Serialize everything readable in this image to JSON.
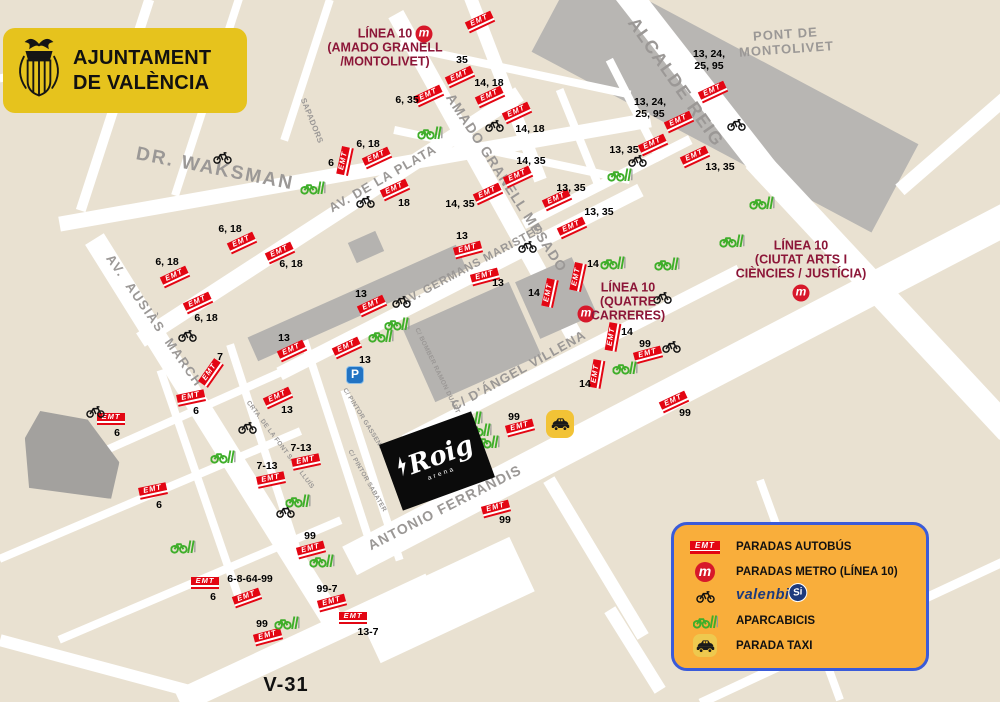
{
  "header": {
    "line1": "AJUNTAMENT",
    "line2": "DE VALÈNCIA"
  },
  "labels": {
    "emt": "EMT",
    "metro_letter": "m"
  },
  "venue": {
    "name": "Roig",
    "sub": "arena"
  },
  "parking": {
    "label": "P",
    "x": 355,
    "y": 375
  },
  "taxi_stands": [
    [
      560,
      424
    ]
  ],
  "colors": {
    "emt_red": "#e30613",
    "metro_red": "#d7182a",
    "metro_label_maroon": "#8c1638",
    "green": "#3fae2a",
    "legend_bg": "#f9ae3b",
    "legend_border": "#3a5bd9",
    "badge_yellow": "#e6c31d",
    "taxi_yellow": "#f2c336",
    "parking_blue": "#2273c3",
    "street_gray": "#9b9896",
    "land_beige": "#e9e1d1",
    "road_white": "#ffffff",
    "building_gray": "#b5b3b0",
    "dark_block_gray": "#a3a19e",
    "number_black": "#000000"
  },
  "legend": {
    "items": [
      {
        "icon": "emt",
        "label": "PARADAS AUTOBÚS"
      },
      {
        "icon": "metro",
        "label": "PARADAS METRO (LÍNEA 10)"
      },
      {
        "icon": "bike",
        "logo_main": "valenbi",
        "logo_badge": "Si",
        "label": "valenbisi"
      },
      {
        "icon": "aparcabicis",
        "label": "APARCABICIS"
      },
      {
        "icon": "taxi",
        "label": "PARADA TAXI"
      }
    ]
  },
  "metro_labels": [
    {
      "text": "LÍNEA 10\n(AMADO GRANELL\n/MONTOLIVET)",
      "x": 385,
      "y": 48
    },
    {
      "text": "LÍNEA 10\n(QUATRE\nCARRERES)",
      "x": 628,
      "y": 302
    },
    {
      "text": "LÍNEA 10\n(CIUTAT ARTS I\nCIÈNCIES / JUSTÍCIA)",
      "x": 801,
      "y": 260
    }
  ],
  "metro_stations": [
    [
      424,
      34
    ],
    [
      586,
      314
    ],
    [
      801,
      293
    ]
  ],
  "streets": [
    {
      "name": "DR. WAKSMAN",
      "x": 215,
      "y": 169,
      "rot": 11,
      "size": 19,
      "ls": 2
    },
    {
      "name": "AV.  AUSIÀS  MARCH",
      "x": 154,
      "y": 321,
      "rot": 55,
      "size": 13,
      "ls": 1.5
    },
    {
      "name": "AV. DE LA PLATA",
      "x": 383,
      "y": 179,
      "rot": -30,
      "size": 13,
      "ls": 1
    },
    {
      "name": "AMADO GRANELL MESADO",
      "x": 506,
      "y": 183,
      "rot": 57,
      "size": 14,
      "ls": 1
    },
    {
      "name": "ALCALDE REIG",
      "x": 676,
      "y": 82,
      "rot": 55,
      "size": 18,
      "ls": 1.5
    },
    {
      "name": "PONT DE\nMONTOLIVET",
      "x": 786,
      "y": 42,
      "rot": -4,
      "size": 13,
      "ls": 1
    },
    {
      "name": "AV. GERMANS MARISTES",
      "x": 473,
      "y": 266,
      "rot": -28,
      "size": 11.5,
      "ls": 0.8
    },
    {
      "name": "C/ D'ÁNGEL VILLENA",
      "x": 519,
      "y": 371,
      "rot": -29,
      "size": 13,
      "ls": 1
    },
    {
      "name": "ANTONIO FERRANDIS",
      "x": 445,
      "y": 508,
      "rot": -27,
      "size": 14,
      "ls": 1.2
    },
    {
      "name": "SAPADORS",
      "x": 311,
      "y": 121,
      "rot": 68,
      "size": 8,
      "ls": 0.4
    },
    {
      "name": "C/ BOMBER RAMON DUART",
      "x": 437,
      "y": 371,
      "rot": 64,
      "size": 6.5,
      "ls": 0.3
    },
    {
      "name": "CRTA. DE LA FONT SANT LLUÍS",
      "x": 280,
      "y": 445,
      "rot": 53,
      "size": 6.5,
      "ls": 0.3
    },
    {
      "name": "C/ PINTOR GASSENT",
      "x": 363,
      "y": 419,
      "rot": 58,
      "size": 6.5,
      "ls": 0.3
    },
    {
      "name": "C/ PINTOR SABATER",
      "x": 367,
      "y": 481,
      "rot": 60,
      "size": 6.5,
      "ls": 0.3
    },
    {
      "name": "V-31",
      "x": 286,
      "y": 685,
      "rot": 0,
      "size": 20,
      "ls": 1,
      "color": "#101010"
    }
  ],
  "bus_stops": [
    [
      480,
      22,
      -25
    ],
    [
      460,
      77,
      -25
    ],
    [
      429,
      96,
      -25
    ],
    [
      490,
      97,
      -25
    ],
    [
      517,
      113,
      -25
    ],
    [
      345,
      161,
      -78
    ],
    [
      377,
      158,
      -25
    ],
    [
      242,
      243,
      -25
    ],
    [
      175,
      277,
      -25
    ],
    [
      280,
      253,
      -25
    ],
    [
      198,
      303,
      -25
    ],
    [
      488,
      194,
      -25
    ],
    [
      518,
      177,
      -25
    ],
    [
      395,
      190,
      -25
    ],
    [
      557,
      200,
      -25
    ],
    [
      572,
      228,
      -25
    ],
    [
      653,
      145,
      -25
    ],
    [
      679,
      122,
      -25
    ],
    [
      713,
      92,
      -25
    ],
    [
      695,
      157,
      -25
    ],
    [
      578,
      277,
      -78
    ],
    [
      550,
      293,
      -78
    ],
    [
      485,
      277,
      -15
    ],
    [
      468,
      250,
      -15
    ],
    [
      372,
      306,
      -25
    ],
    [
      292,
      351,
      -25
    ],
    [
      347,
      348,
      -25
    ],
    [
      211,
      373,
      -55
    ],
    [
      191,
      398,
      -12
    ],
    [
      111,
      419,
      0
    ],
    [
      278,
      398,
      -25
    ],
    [
      306,
      462,
      -12
    ],
    [
      271,
      480,
      -12
    ],
    [
      153,
      491,
      -12
    ],
    [
      311,
      550,
      -15
    ],
    [
      205,
      583,
      0
    ],
    [
      247,
      598,
      -20
    ],
    [
      332,
      603,
      -15
    ],
    [
      268,
      637,
      -15
    ],
    [
      353,
      618,
      0
    ],
    [
      496,
      509,
      -15
    ],
    [
      520,
      428,
      -15
    ],
    [
      597,
      374,
      -80
    ],
    [
      613,
      337,
      -80
    ],
    [
      648,
      355,
      -15
    ],
    [
      674,
      402,
      -25
    ]
  ],
  "bus_numbers": [
    [
      "35",
      462,
      60
    ],
    [
      "6, 35",
      407,
      100
    ],
    [
      "14, 18",
      489,
      83
    ],
    [
      "14, 18",
      530,
      129
    ],
    [
      "6",
      331,
      163
    ],
    [
      "6, 18",
      368,
      144
    ],
    [
      "6, 18",
      230,
      229
    ],
    [
      "6, 18",
      167,
      262
    ],
    [
      "6, 18",
      291,
      264
    ],
    [
      "6, 18",
      206,
      318
    ],
    [
      "14, 35",
      460,
      204
    ],
    [
      "14, 35",
      531,
      161
    ],
    [
      "18",
      404,
      203
    ],
    [
      "13, 35",
      571,
      188
    ],
    [
      "13, 35",
      599,
      212
    ],
    [
      "13, 35",
      624,
      150
    ],
    [
      "13, 24,\n25, 95",
      650,
      108
    ],
    [
      "13, 24,\n25, 95",
      709,
      60
    ],
    [
      "13, 35",
      720,
      167
    ],
    [
      "14",
      593,
      264
    ],
    [
      "14",
      534,
      293
    ],
    [
      "13",
      498,
      283
    ],
    [
      "13",
      462,
      236
    ],
    [
      "13",
      361,
      294
    ],
    [
      "13",
      284,
      338
    ],
    [
      "13",
      365,
      360
    ],
    [
      "7",
      220,
      357
    ],
    [
      "6",
      196,
      411
    ],
    [
      "6",
      117,
      433
    ],
    [
      "13",
      287,
      410
    ],
    [
      "7-13",
      301,
      448
    ],
    [
      "7-13",
      267,
      466
    ],
    [
      "6",
      159,
      505
    ],
    [
      "99",
      310,
      536
    ],
    [
      "6-8-64-99",
      250,
      579
    ],
    [
      "6",
      213,
      597
    ],
    [
      "99-7",
      327,
      589
    ],
    [
      "99",
      262,
      624
    ],
    [
      "13-7",
      368,
      632
    ],
    [
      "99",
      505,
      520
    ],
    [
      "99",
      514,
      417
    ],
    [
      "14",
      585,
      384
    ],
    [
      "14",
      627,
      332
    ],
    [
      "99",
      645,
      344
    ],
    [
      "99",
      685,
      413
    ]
  ],
  "valenbisi_stations": [
    [
      223,
      158
    ],
    [
      96,
      412
    ],
    [
      366,
      202
    ],
    [
      495,
      126
    ],
    [
      638,
      161
    ],
    [
      737,
      125
    ],
    [
      402,
      302
    ],
    [
      528,
      247
    ],
    [
      663,
      298
    ],
    [
      672,
      347
    ],
    [
      248,
      428
    ],
    [
      286,
      512
    ],
    [
      188,
      336
    ]
  ],
  "bike_parkings": [
    [
      313,
      187
    ],
    [
      430,
      132
    ],
    [
      620,
      174
    ],
    [
      762,
      202
    ],
    [
      732,
      240
    ],
    [
      613,
      262
    ],
    [
      667,
      263
    ],
    [
      625,
      367
    ],
    [
      397,
      323
    ],
    [
      381,
      335
    ],
    [
      223,
      456
    ],
    [
      298,
      500
    ],
    [
      183,
      546
    ],
    [
      322,
      560
    ],
    [
      287,
      622
    ],
    [
      470,
      417
    ],
    [
      479,
      429
    ],
    [
      487,
      441
    ]
  ],
  "map": {
    "river": [
      725,
      98,
      385,
      100,
      28,
      "#b8b6b3"
    ],
    "gray_blocks": [
      [
        357,
        303,
        228,
        26,
        -24,
        "#b5b3b0",
        false
      ],
      [
        472,
        342,
        116,
        80,
        -24,
        "#b5b3b0",
        false
      ],
      [
        556,
        298,
        62,
        62,
        -24,
        "#b5b3b0",
        false
      ],
      [
        366,
        247,
        30,
        22,
        -24,
        "#b5b3b0",
        false
      ],
      [
        72,
        452,
        96,
        88,
        4,
        "#a3a19e",
        true
      ]
    ],
    "roads": [
      [
        355,
        172,
        600,
        15,
        -10
      ],
      [
        215,
        432,
        455,
        22,
        58
      ],
      [
        330,
        217,
        452,
        16,
        -33
      ],
      [
        485,
        175,
        368,
        17,
        61
      ],
      [
        695,
        80,
        230,
        26,
        52
      ],
      [
        882,
        295,
        372,
        26,
        47
      ],
      [
        460,
        282,
        405,
        14,
        -27
      ],
      [
        572,
        356,
        376,
        13,
        -27
      ],
      [
        680,
        389,
        745,
        32,
        -27.5
      ],
      [
        305,
        643,
        277,
        24,
        -25
      ],
      [
        100,
        667,
        207,
        12,
        15
      ],
      [
        504,
        85,
        204,
        13,
        69
      ],
      [
        445,
        600,
        170,
        60,
        -25
      ],
      [
        115,
        105,
        222,
        10,
        -72
      ],
      [
        207,
        97,
        207,
        8,
        -72
      ],
      [
        307,
        70,
        148,
        8,
        -72
      ],
      [
        110,
        57,
        225,
        8,
        -11
      ],
      [
        185,
        415,
        318,
        8,
        -24
      ],
      [
        150,
        495,
        327,
        8,
        -23
      ],
      [
        200,
        580,
        306,
        8,
        -23
      ],
      [
        265,
        452,
        226,
        8,
        72
      ],
      [
        200,
        485,
        243,
        8,
        71
      ],
      [
        335,
        435,
        221,
        8,
        72
      ],
      [
        372,
        475,
        179,
        8,
        72
      ],
      [
        955,
        142,
        146,
        14,
        -41
      ],
      [
        596,
        558,
        183,
        13,
        59
      ],
      [
        635,
        650,
        95,
        13,
        58
      ],
      [
        855,
        631,
        341,
        9,
        -25
      ],
      [
        800,
        590,
        234,
        8,
        70
      ],
      [
        515,
        70,
        236,
        8,
        12
      ],
      [
        512,
        155,
        241,
        8,
        12
      ],
      [
        607,
        182,
        187,
        10,
        -27
      ],
      [
        580,
        140,
        109,
        8,
        68
      ],
      [
        635,
        110,
        113,
        8,
        63
      ]
    ]
  }
}
